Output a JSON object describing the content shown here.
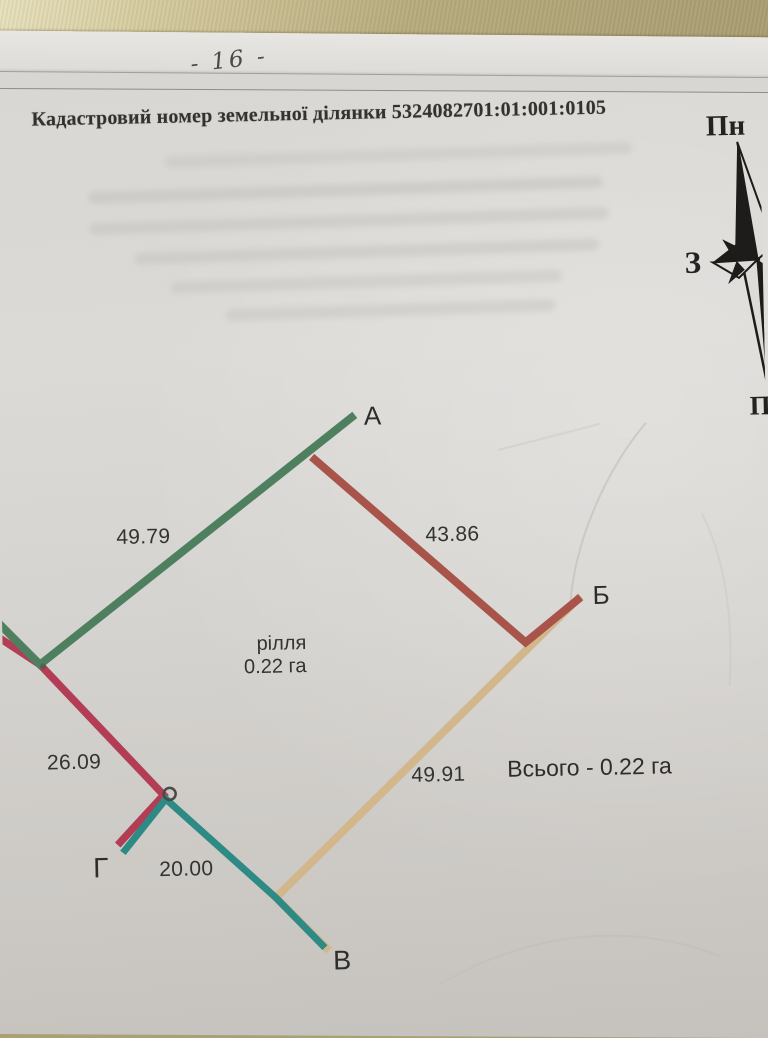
{
  "page": {
    "page_number": "- 16 -",
    "header": "Кадастровий номер земельної ділянки 5324082701:01:001:0105"
  },
  "compass": {
    "north_label": "Пн",
    "west_label": "З",
    "south_label": "Пд"
  },
  "parcel": {
    "land_use_label": "рілля",
    "area_label": "0.22 га",
    "total_label": "Всього - 0.22 га",
    "vertices": [
      {
        "name": "А"
      },
      {
        "name": "Б"
      },
      {
        "name": "В"
      },
      {
        "name": "Г"
      }
    ],
    "sides": [
      {
        "from": "edge",
        "to": "А",
        "length": "49.79",
        "color": "#4e8060"
      },
      {
        "from": "А",
        "to": "Б",
        "length": "43.86",
        "color": "#a8544a"
      },
      {
        "from": "Б",
        "to": "В",
        "length": "49.91",
        "color": "#d3b78c"
      },
      {
        "from": "В",
        "to": "Г",
        "length": "20.00",
        "color": "#2e8a85"
      },
      {
        "from": "Г",
        "to": "edge",
        "length": "26.09",
        "color": "#b23d55"
      }
    ],
    "marker_color": "#4a4a48",
    "compass_color": "#1d1c1a"
  }
}
